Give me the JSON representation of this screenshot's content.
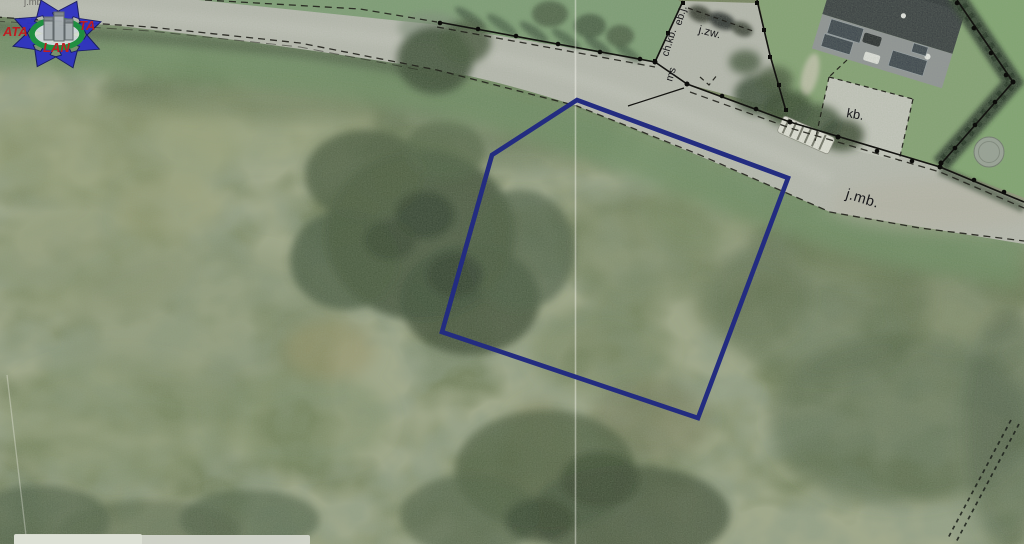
{
  "map": {
    "kind": "aerial-cadastral-photo",
    "plot_outline": {
      "points": "577,100 788,178 698,418 442,332 492,155",
      "color": "#232c80"
    },
    "labels": {
      "road": "j.mb.",
      "road_top_partial": "j.mb.",
      "gravel_area": "kb.",
      "yard_area": "j.zw.",
      "boundary_chkb": "ch.kb.",
      "boundary_ebj": "eb.j.",
      "boundary_ms": "ms"
    }
  },
  "watermark": {
    "text_left": "ATA",
    "text_right": "TA",
    "text_bottom": "LAN",
    "arrow_color": "#2b2fc2",
    "ring_color": "#1a8f3e",
    "text_color": "#c2161d"
  }
}
